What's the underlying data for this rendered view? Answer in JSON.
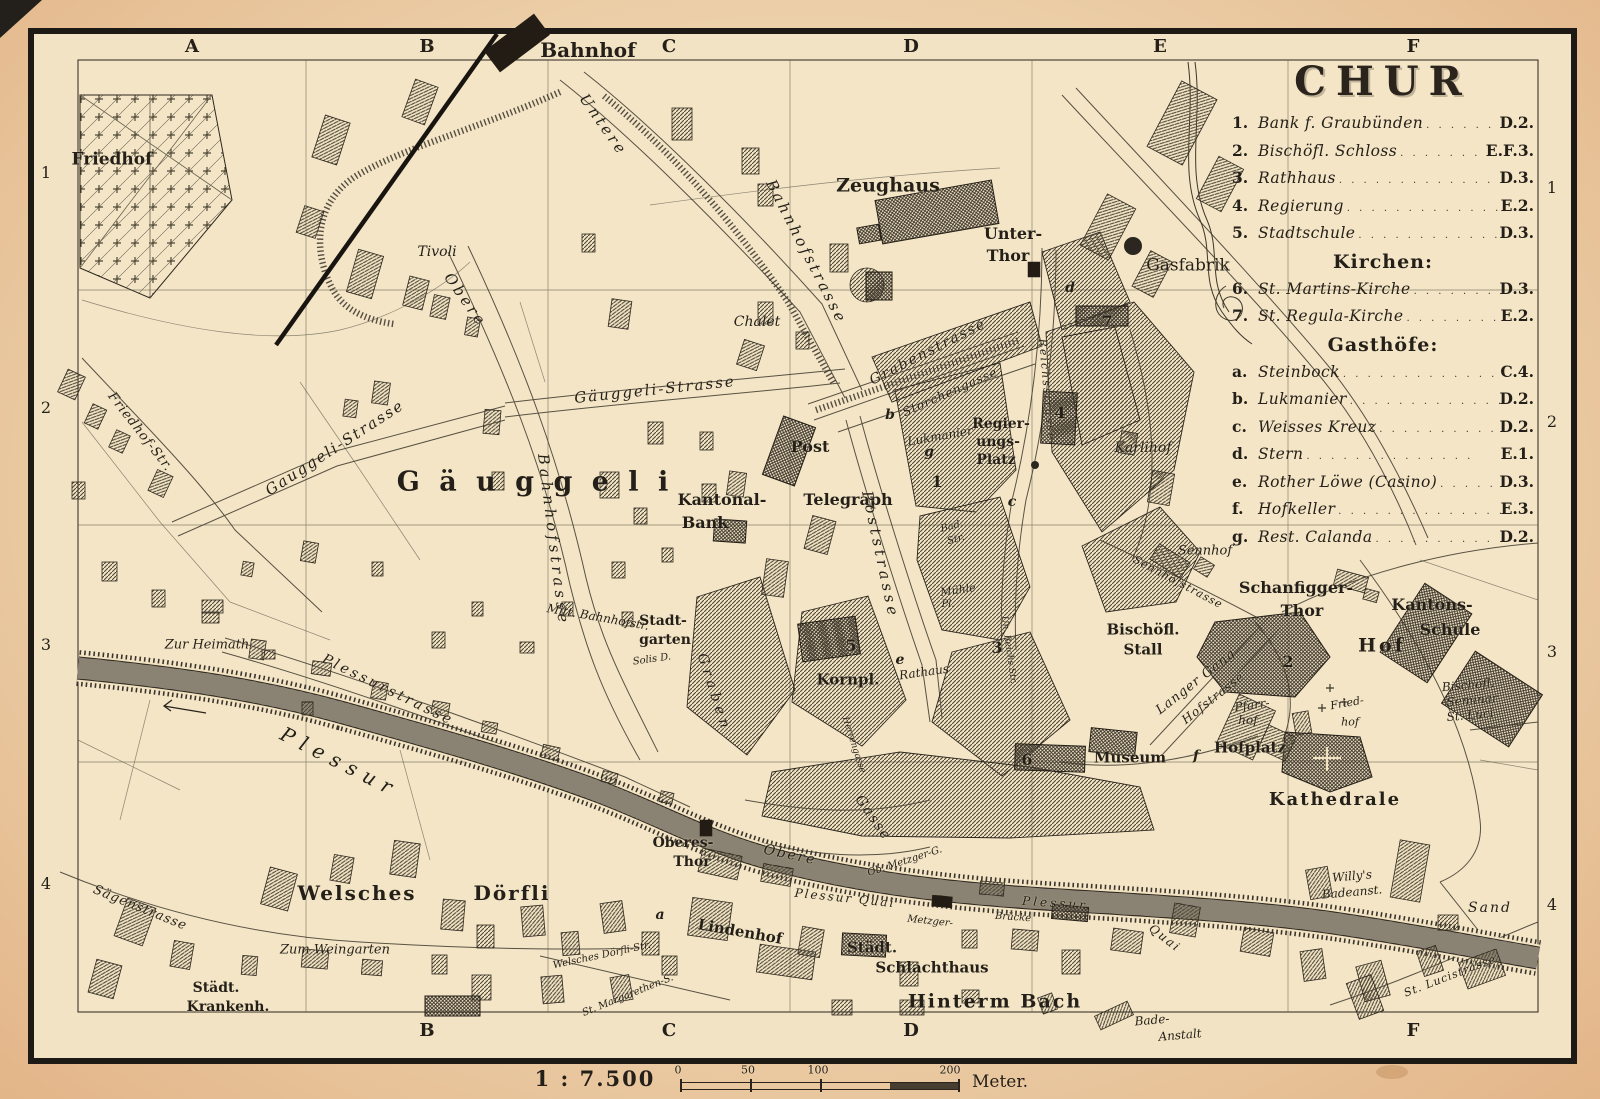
{
  "legend": {
    "title": "CHUR",
    "sections": [
      {
        "items": [
          {
            "key": "1.",
            "name": "Bank f. Graubünden",
            "loc": "D.2."
          },
          {
            "key": "2.",
            "name": "Bischöfl. Schloss",
            "loc": "E.F.3."
          },
          {
            "key": "3.",
            "name": "Rathhaus",
            "loc": "D.3."
          },
          {
            "key": "4.",
            "name": "Regierung",
            "loc": "E.2."
          },
          {
            "key": "5.",
            "name": "Stadtschule",
            "loc": "D.3."
          }
        ]
      },
      {
        "header": "Kirchen:",
        "items": [
          {
            "key": "6.",
            "name": "St. Martins-Kirche",
            "loc": "D.3."
          },
          {
            "key": "7.",
            "name": "St. Regula-Kirche",
            "loc": "E.2."
          }
        ]
      },
      {
        "header": "Gasthöfe:",
        "items": [
          {
            "key": "a.",
            "name": "Steinbock",
            "loc": "C.4."
          },
          {
            "key": "b.",
            "name": "Lukmanier",
            "loc": "D.2."
          },
          {
            "key": "c.",
            "name": "Weisses Kreuz",
            "loc": "D.2."
          },
          {
            "key": "d.",
            "name": "Stern",
            "loc": "E.1."
          },
          {
            "key": "e.",
            "name": "Rother Löwe (Casino)",
            "loc": "D.3."
          },
          {
            "key": "f.",
            "name": "Hofkeller",
            "loc": "E.3."
          },
          {
            "key": "g.",
            "name": "Rest. Calanda",
            "loc": "D.2."
          }
        ]
      }
    ]
  },
  "grid": {
    "top": [
      "A",
      "B",
      "C",
      "D",
      "E",
      "F"
    ],
    "bottom": [
      "B",
      "C",
      "D",
      "F"
    ],
    "left": [
      "1",
      "2",
      "3",
      "4"
    ],
    "right": [
      "1",
      "2",
      "3",
      "4"
    ]
  },
  "scale": {
    "ratio": "1 : 7.500",
    "ticks": [
      "0",
      "50",
      "100",
      "200"
    ],
    "unit": "Meter."
  },
  "map_labels": [
    {
      "t": "Friedhof",
      "x": 112,
      "y": 160,
      "s": 17,
      "f": "b"
    },
    {
      "t": "Bahnhof",
      "x": 588,
      "y": 50,
      "s": 20,
      "f": "b"
    },
    {
      "t": "Tivoli",
      "x": 437,
      "y": 252,
      "s": 14,
      "f": "i"
    },
    {
      "t": "Untere",
      "x": 603,
      "y": 125,
      "s": 15,
      "f": "i",
      "r": 55,
      "ls": 3
    },
    {
      "t": "Bahnhofstrasse",
      "x": 806,
      "y": 252,
      "s": 15,
      "f": "i",
      "r": 63,
      "ls": 3
    },
    {
      "t": "Zeughaus",
      "x": 888,
      "y": 186,
      "s": 19,
      "f": "b"
    },
    {
      "t": "Chalet",
      "x": 757,
      "y": 322,
      "s": 14,
      "f": "i"
    },
    {
      "t": "Unter-",
      "x": 1013,
      "y": 234,
      "s": 16,
      "f": "b"
    },
    {
      "t": "Thor",
      "x": 1008,
      "y": 256,
      "s": 16,
      "f": "b"
    },
    {
      "t": "Gasfabrik",
      "x": 1188,
      "y": 266,
      "s": 17,
      "f": "r"
    },
    {
      "t": "Grabenstrasse",
      "x": 928,
      "y": 352,
      "s": 14,
      "f": "i",
      "r": -27,
      "ls": 2
    },
    {
      "t": "Storchengasse",
      "x": 950,
      "y": 392,
      "s": 12,
      "f": "i",
      "r": -24,
      "ls": 1
    },
    {
      "t": "Gäuggeli-Strasse",
      "x": 655,
      "y": 390,
      "s": 15,
      "f": "i",
      "r": -6,
      "ls": 2
    },
    {
      "t": "Gauggeli-Strasse",
      "x": 335,
      "y": 448,
      "s": 15,
      "f": "i",
      "r": -33,
      "ls": 2
    },
    {
      "t": "G ä u g g e l i",
      "x": 535,
      "y": 482,
      "s": 27,
      "f": "b",
      "ls": 5
    },
    {
      "t": "Kantonal-",
      "x": 722,
      "y": 500,
      "s": 16,
      "f": "b"
    },
    {
      "t": "Bank",
      "x": 705,
      "y": 523,
      "s": 16,
      "f": "b"
    },
    {
      "t": "Post",
      "x": 810,
      "y": 447,
      "s": 16,
      "f": "b"
    },
    {
      "t": "Telegraph",
      "x": 848,
      "y": 500,
      "s": 16,
      "f": "b"
    },
    {
      "t": "Regier-",
      "x": 1001,
      "y": 424,
      "s": 14,
      "f": "b"
    },
    {
      "t": "ungs-",
      "x": 998,
      "y": 442,
      "s": 14,
      "f": "b"
    },
    {
      "t": "Platz",
      "x": 996,
      "y": 460,
      "s": 14,
      "f": "b"
    },
    {
      "t": "Karlihof",
      "x": 1143,
      "y": 448,
      "s": 14,
      "f": "i"
    },
    {
      "t": "Poststrasse",
      "x": 880,
      "y": 555,
      "s": 15,
      "f": "i",
      "r": 78,
      "ls": 4
    },
    {
      "t": "Obere",
      "x": 465,
      "y": 300,
      "s": 15,
      "f": "i",
      "r": 55,
      "ls": 3
    },
    {
      "t": "Bahnhofstrasse",
      "x": 553,
      "y": 540,
      "s": 15,
      "f": "i",
      "r": 83,
      "ls": 4
    },
    {
      "t": "Mitt. Bahnhofstr.",
      "x": 598,
      "y": 617,
      "s": 12,
      "f": "i",
      "r": 10
    },
    {
      "t": "Stadt-",
      "x": 663,
      "y": 621,
      "s": 14,
      "f": "b"
    },
    {
      "t": "garten",
      "x": 665,
      "y": 640,
      "s": 14,
      "f": "b"
    },
    {
      "t": "Solis D.",
      "x": 652,
      "y": 660,
      "s": 10,
      "f": "i",
      "r": -8
    },
    {
      "t": "Friedhof-Str.",
      "x": 140,
      "y": 432,
      "s": 13,
      "f": "i",
      "r": 52,
      "ls": 1
    },
    {
      "t": "Zur Heimath",
      "x": 207,
      "y": 645,
      "s": 13,
      "f": "i"
    },
    {
      "t": "Plessurstrasse",
      "x": 388,
      "y": 690,
      "s": 14,
      "f": "i",
      "r": 26,
      "ls": 3
    },
    {
      "t": "Plessur",
      "x": 340,
      "y": 762,
      "s": 20,
      "f": "i",
      "r": 27,
      "ls": 8
    },
    {
      "t": "Plessur  Quai",
      "x": 845,
      "y": 898,
      "s": 12,
      "f": "i",
      "r": 6,
      "ls": 2
    },
    {
      "t": "Metzger-",
      "x": 930,
      "y": 922,
      "s": 10,
      "f": "i",
      "r": 6
    },
    {
      "t": "Brücke",
      "x": 1013,
      "y": 918,
      "s": 10,
      "f": "i",
      "r": 4
    },
    {
      "t": "Plessur",
      "x": 1055,
      "y": 903,
      "s": 12,
      "f": "i",
      "r": 4,
      "ls": 3
    },
    {
      "t": "Quai",
      "x": 1165,
      "y": 938,
      "s": 12,
      "f": "i",
      "r": 38,
      "ls": 2
    },
    {
      "t": "Oberes-",
      "x": 683,
      "y": 843,
      "s": 14,
      "f": "b"
    },
    {
      "t": "Thor",
      "x": 692,
      "y": 862,
      "s": 14,
      "f": "b"
    },
    {
      "t": "Obere",
      "x": 790,
      "y": 855,
      "s": 14,
      "f": "i",
      "r": 12,
      "ls": 2
    },
    {
      "t": "Gasse",
      "x": 873,
      "y": 818,
      "s": 14,
      "f": "i",
      "r": 55,
      "ls": 2
    },
    {
      "t": "Kornpl.",
      "x": 848,
      "y": 680,
      "s": 15,
      "f": "b"
    },
    {
      "t": "Rathaus",
      "x": 924,
      "y": 672,
      "s": 12,
      "f": "i",
      "r": -8
    },
    {
      "t": "Ob. Metzger-G.",
      "x": 905,
      "y": 862,
      "s": 10,
      "f": "i",
      "r": -18
    },
    {
      "t": "Mühle",
      "x": 958,
      "y": 590,
      "s": 11,
      "f": "i",
      "r": -8
    },
    {
      "t": "Pl.",
      "x": 948,
      "y": 605,
      "s": 10,
      "f": "i"
    },
    {
      "t": "Bad.",
      "x": 952,
      "y": 527,
      "s": 10,
      "f": "i",
      "r": -15
    },
    {
      "t": "Str.",
      "x": 956,
      "y": 540,
      "s": 10,
      "f": "i",
      "r": -15
    },
    {
      "t": "Lukmanier",
      "x": 940,
      "y": 436,
      "s": 12,
      "f": "i",
      "r": -10
    },
    {
      "t": "Reichsstrasse",
      "x": 1047,
      "y": 390,
      "s": 11,
      "f": "i",
      "r": 85,
      "ls": 2
    },
    {
      "t": "Un. Reichs Str.",
      "x": 1008,
      "y": 650,
      "s": 9,
      "f": "i",
      "r": 82
    },
    {
      "t": "Herrengasse",
      "x": 853,
      "y": 745,
      "s": 9,
      "f": "i",
      "r": 72
    },
    {
      "t": "Graben",
      "x": 714,
      "y": 693,
      "s": 14,
      "f": "i",
      "r": 72,
      "ls": 5
    },
    {
      "t": "Sennhof",
      "x": 1205,
      "y": 551,
      "s": 13,
      "f": "i"
    },
    {
      "t": "Sennhofstrasse",
      "x": 1178,
      "y": 582,
      "s": 11,
      "f": "i",
      "r": 28,
      "ls": 1
    },
    {
      "t": "Bischöfl.",
      "x": 1143,
      "y": 630,
      "s": 15,
      "f": "b"
    },
    {
      "t": "Stall",
      "x": 1143,
      "y": 650,
      "s": 15,
      "f": "b"
    },
    {
      "t": "Langer Gang",
      "x": 1196,
      "y": 682,
      "s": 13,
      "f": "i",
      "r": -38,
      "ls": 1
    },
    {
      "t": "Hofstrasse",
      "x": 1213,
      "y": 698,
      "s": 12,
      "f": "i",
      "r": -38,
      "ls": 1
    },
    {
      "t": "Schanfigger-",
      "x": 1296,
      "y": 588,
      "s": 16,
      "f": "b"
    },
    {
      "t": "Thor",
      "x": 1302,
      "y": 611,
      "s": 16,
      "f": "b"
    },
    {
      "t": "Hof",
      "x": 1382,
      "y": 646,
      "s": 19,
      "f": "b",
      "ls": 3
    },
    {
      "t": "Kantons-",
      "x": 1432,
      "y": 605,
      "s": 16,
      "f": "b"
    },
    {
      "t": "Schule",
      "x": 1450,
      "y": 630,
      "s": 16,
      "f": "b"
    },
    {
      "t": "Bischöfl.",
      "x": 1468,
      "y": 685,
      "s": 12,
      "f": "i",
      "r": -5
    },
    {
      "t": "Seminar",
      "x": 1472,
      "y": 700,
      "s": 12,
      "f": "i",
      "r": -5
    },
    {
      "t": "St. Luci",
      "x": 1470,
      "y": 715,
      "s": 12,
      "f": "i",
      "r": -5
    },
    {
      "t": "Pfarr-",
      "x": 1252,
      "y": 705,
      "s": 12,
      "f": "i",
      "r": -8
    },
    {
      "t": "hof",
      "x": 1248,
      "y": 720,
      "s": 12,
      "f": "i"
    },
    {
      "t": "Fried-",
      "x": 1347,
      "y": 703,
      "s": 11,
      "f": "i",
      "r": -10
    },
    {
      "t": "hof",
      "x": 1350,
      "y": 722,
      "s": 11,
      "f": "i"
    },
    {
      "t": "Hofplatz",
      "x": 1250,
      "y": 748,
      "s": 15,
      "f": "b"
    },
    {
      "t": "Museum",
      "x": 1130,
      "y": 758,
      "s": 15,
      "f": "b"
    },
    {
      "t": "Kathedrale",
      "x": 1335,
      "y": 800,
      "s": 18,
      "f": "b",
      "ls": 2
    },
    {
      "t": "Willy's",
      "x": 1352,
      "y": 876,
      "s": 12,
      "f": "i",
      "r": -5
    },
    {
      "t": "Badeanst.",
      "x": 1352,
      "y": 892,
      "s": 12,
      "f": "i",
      "r": -5
    },
    {
      "t": "Sand",
      "x": 1490,
      "y": 908,
      "s": 14,
      "f": "i",
      "ls": 2
    },
    {
      "t": "St. Lucistrasse",
      "x": 1450,
      "y": 976,
      "s": 11,
      "f": "i",
      "r": -21,
      "ls": 1
    },
    {
      "t": "Lindenhof",
      "x": 740,
      "y": 932,
      "s": 15,
      "f": "b",
      "r": 10
    },
    {
      "t": "Städt.",
      "x": 872,
      "y": 948,
      "s": 15,
      "f": "b"
    },
    {
      "t": "Schlachthaus",
      "x": 932,
      "y": 968,
      "s": 15,
      "f": "b"
    },
    {
      "t": "Hinterm Bach",
      "x": 995,
      "y": 1002,
      "s": 19,
      "f": "b",
      "ls": 2
    },
    {
      "t": "Bade-",
      "x": 1152,
      "y": 1020,
      "s": 12,
      "f": "i",
      "r": -5
    },
    {
      "t": "Anstalt",
      "x": 1180,
      "y": 1035,
      "s": 12,
      "f": "i",
      "r": -5
    },
    {
      "t": "Welsches",
      "x": 357,
      "y": 893,
      "s": 20,
      "f": "b",
      "ls": 2
    },
    {
      "t": "Dörfli",
      "x": 512,
      "y": 893,
      "s": 20,
      "f": "b",
      "ls": 2
    },
    {
      "t": "Zum Weingarten",
      "x": 335,
      "y": 950,
      "s": 13,
      "f": "i"
    },
    {
      "t": "Welsches Dörfli-Str.",
      "x": 602,
      "y": 956,
      "s": 10,
      "f": "i",
      "r": -12
    },
    {
      "t": "St. Margarethen-S.",
      "x": 628,
      "y": 996,
      "s": 10,
      "f": "i",
      "r": -22
    },
    {
      "t": "Städt.",
      "x": 216,
      "y": 988,
      "s": 14,
      "f": "b"
    },
    {
      "t": "Krankenh.",
      "x": 228,
      "y": 1007,
      "s": 14,
      "f": "b"
    },
    {
      "t": "Sägenstrasse",
      "x": 140,
      "y": 908,
      "s": 13,
      "f": "i",
      "r": 22,
      "ls": 1
    },
    {
      "t": "1",
      "x": 937,
      "y": 482,
      "s": 16,
      "f": "b"
    },
    {
      "t": "2",
      "x": 1288,
      "y": 662,
      "s": 16,
      "f": "b"
    },
    {
      "t": "3",
      "x": 997,
      "y": 648,
      "s": 16,
      "f": "b"
    },
    {
      "t": "4",
      "x": 1060,
      "y": 413,
      "s": 16,
      "f": "b"
    },
    {
      "t": "5",
      "x": 851,
      "y": 646,
      "s": 16,
      "f": "b"
    },
    {
      "t": "6",
      "x": 1027,
      "y": 760,
      "s": 16,
      "f": "b"
    },
    {
      "t": "7",
      "x": 1107,
      "y": 322,
      "s": 16,
      "f": "b"
    },
    {
      "t": "a",
      "x": 660,
      "y": 915,
      "s": 14,
      "f": "bi"
    },
    {
      "t": "b",
      "x": 890,
      "y": 415,
      "s": 14,
      "f": "bi"
    },
    {
      "t": "c",
      "x": 1012,
      "y": 502,
      "s": 14,
      "f": "bi"
    },
    {
      "t": "d",
      "x": 1070,
      "y": 288,
      "s": 14,
      "f": "bi"
    },
    {
      "t": "e",
      "x": 900,
      "y": 660,
      "s": 14,
      "f": "bi"
    },
    {
      "t": "f",
      "x": 1196,
      "y": 756,
      "s": 14,
      "f": "bi"
    },
    {
      "t": "g",
      "x": 929,
      "y": 452,
      "s": 14,
      "f": "bi"
    }
  ]
}
